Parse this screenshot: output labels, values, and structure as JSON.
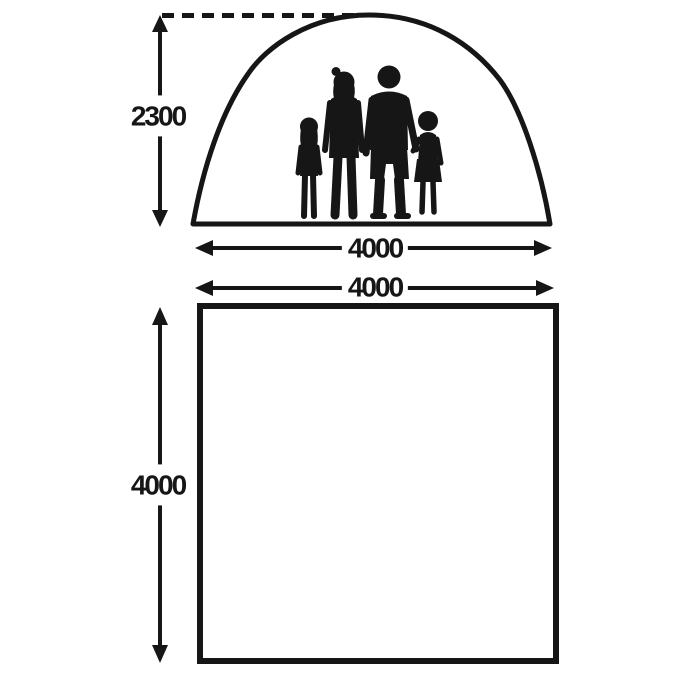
{
  "diagram": {
    "subject": "tent-dimensions-diagram",
    "colors": {
      "ink": "#161616",
      "background": "#ffffff"
    },
    "front_elevation": {
      "figure": "tent-outline-with-family-silhouette",
      "height_label": "2300",
      "width_label": "4000"
    },
    "floor_plan": {
      "figure": "floorplan-square",
      "width_label": "4000",
      "depth_label": "4000"
    }
  }
}
